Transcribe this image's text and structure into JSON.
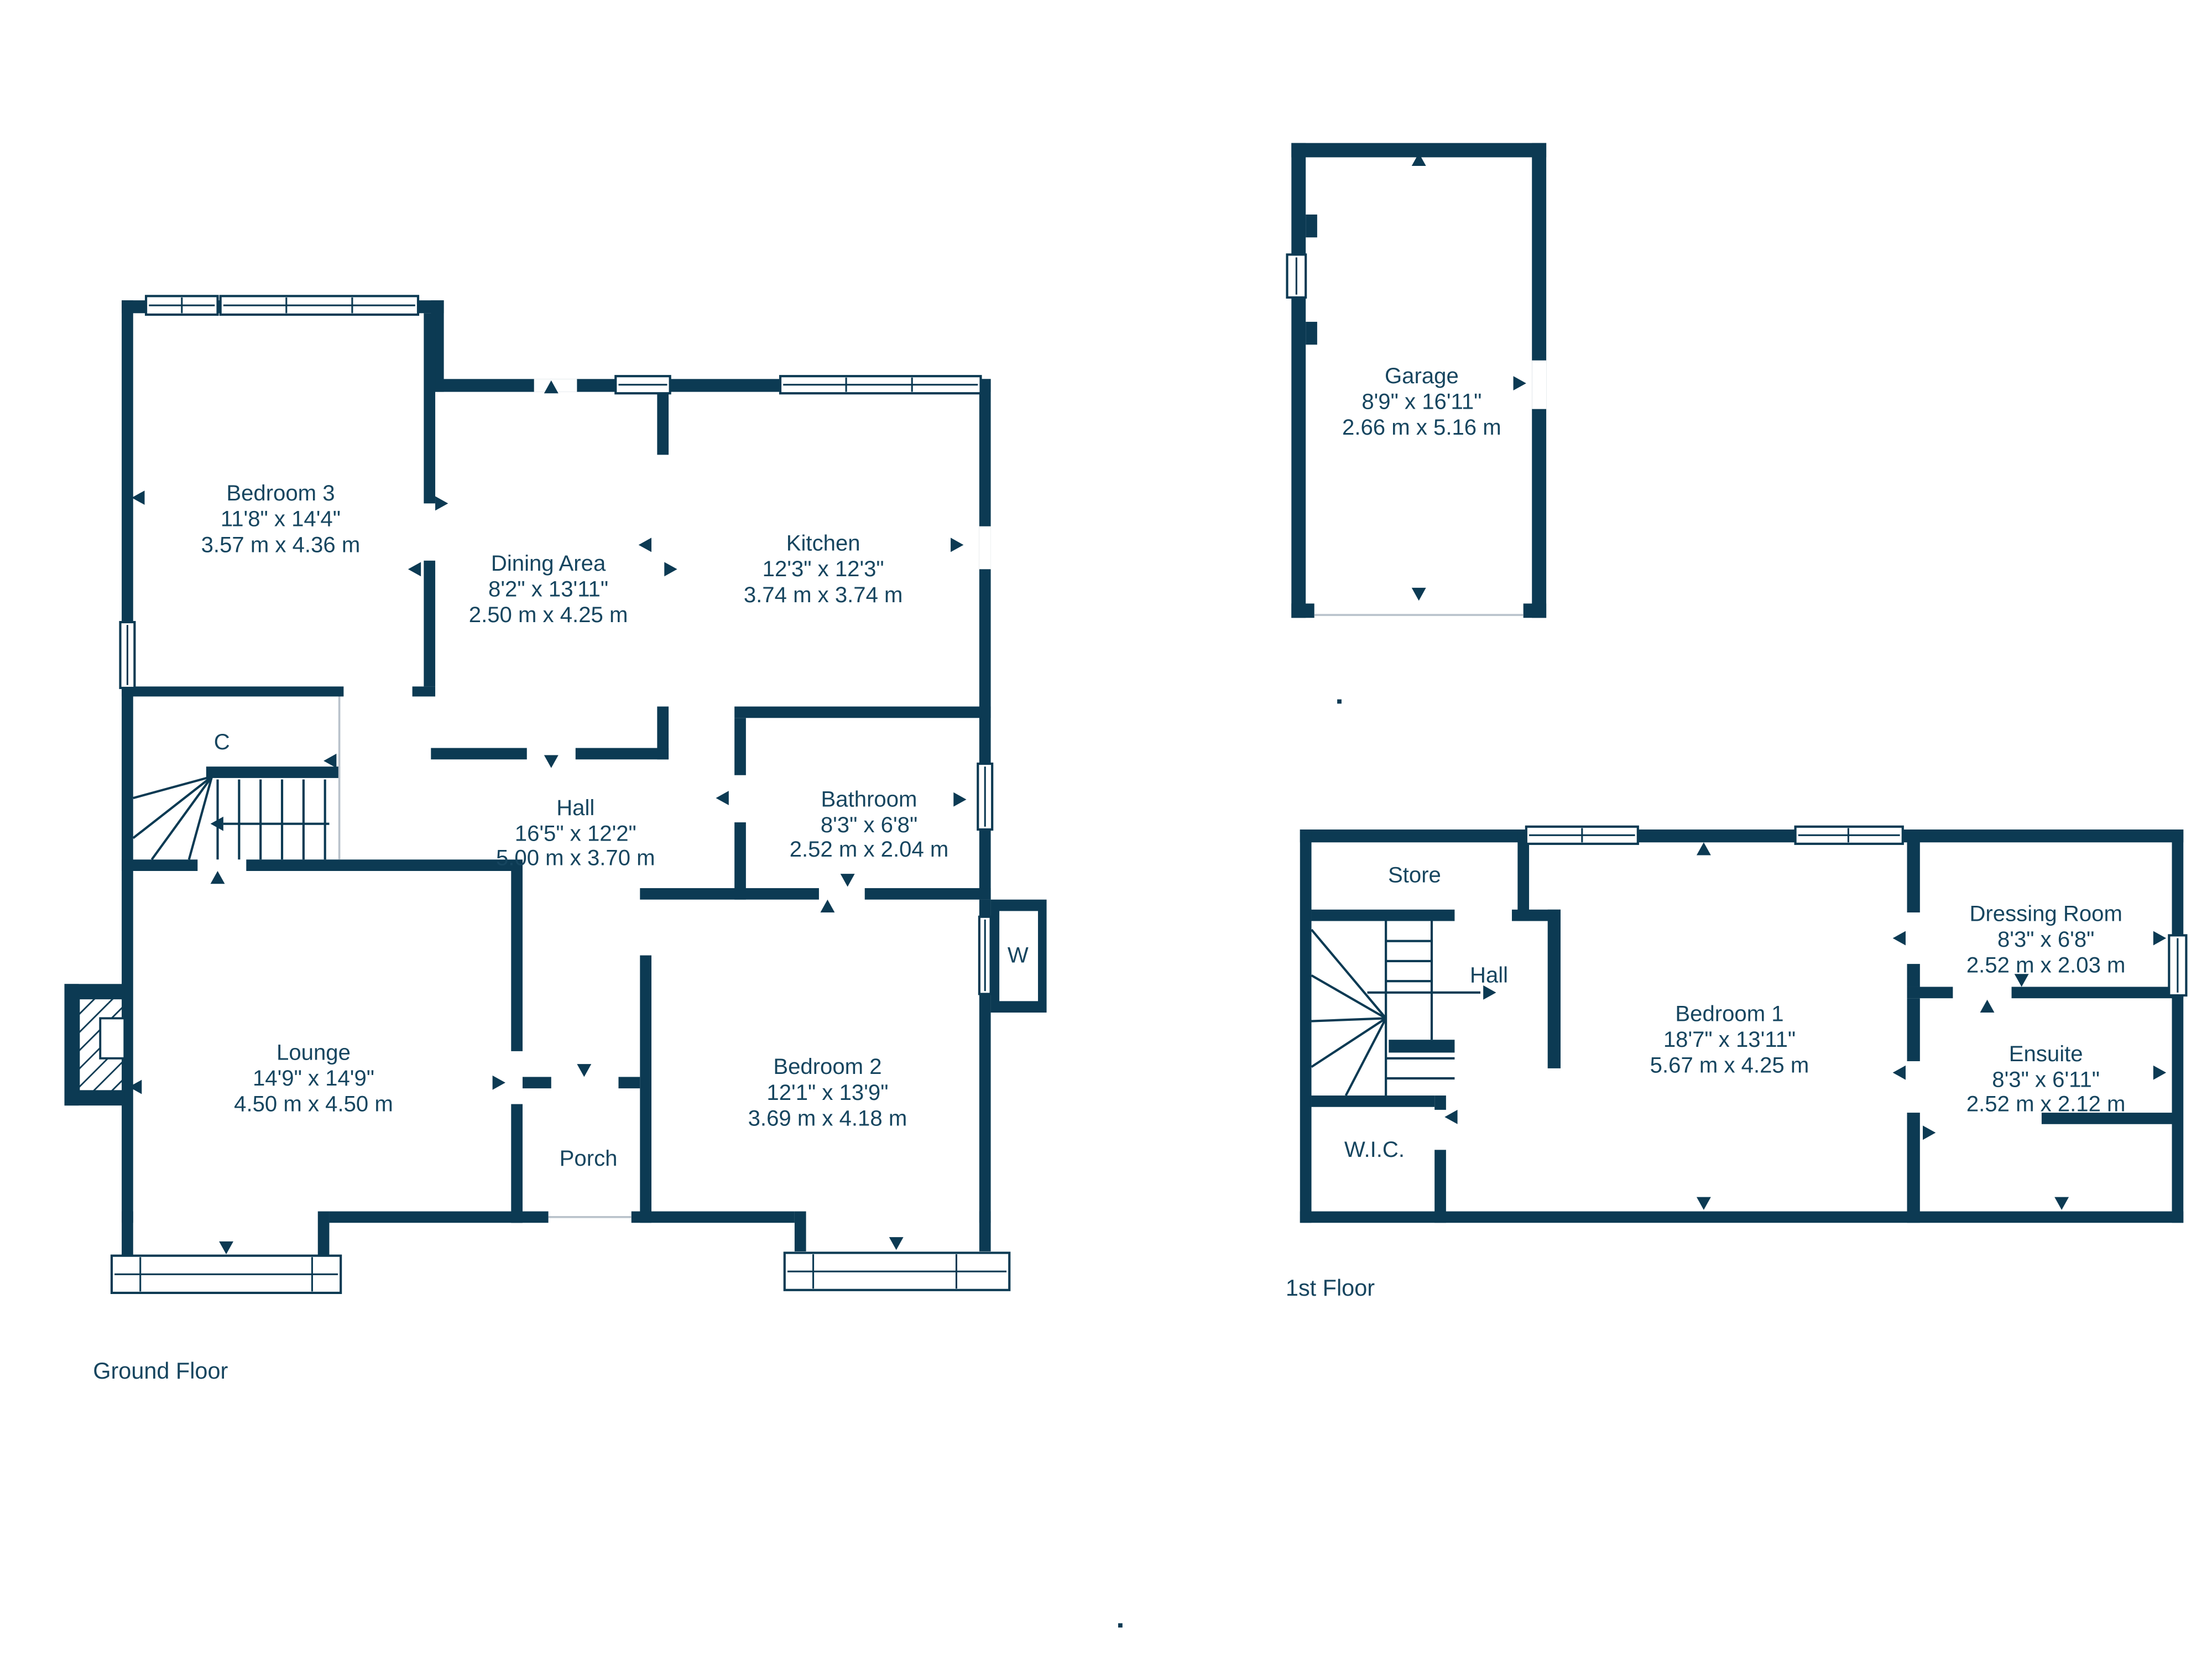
{
  "colors": {
    "wall": "#0c3a53",
    "text": "#16455f",
    "light_line": "#b9c2cb"
  },
  "floors": {
    "ground": {
      "label": "Ground Floor",
      "rooms": {
        "bedroom3": {
          "name": "Bedroom 3",
          "imperial": "11'8\" x 14'4\"",
          "metric": "3.57 m x 4.36 m"
        },
        "dining": {
          "name": "Dining Area",
          "imperial": "8'2\" x 13'11\"",
          "metric": "2.50 m x 4.25 m"
        },
        "kitchen": {
          "name": "Kitchen",
          "imperial": "12'3\" x 12'3\"",
          "metric": "3.74 m x 3.74 m"
        },
        "hall": {
          "name": "Hall",
          "imperial": "16'5\" x 12'2\"",
          "metric": "5.00 m x 3.70 m"
        },
        "bathroom": {
          "name": "Bathroom",
          "imperial": "8'3\" x 6'8\"",
          "metric": "2.52 m x 2.04 m"
        },
        "lounge": {
          "name": "Lounge",
          "imperial": "14'9\" x 14'9\"",
          "metric": "4.50 m x 4.50 m"
        },
        "bedroom2": {
          "name": "Bedroom 2",
          "imperial": "12'1\" x 13'9\"",
          "metric": "3.69 m x 4.18 m"
        },
        "porch": {
          "name": "Porch"
        },
        "cupboard": {
          "name": "C"
        },
        "wardrobe": {
          "name": "W"
        }
      }
    },
    "first": {
      "label": "1st Floor",
      "rooms": {
        "store": {
          "name": "Store"
        },
        "hall": {
          "name": "Hall"
        },
        "bedroom1": {
          "name": "Bedroom 1",
          "imperial": "18'7\" x 13'11\"",
          "metric": "5.67 m x 4.25 m"
        },
        "dressing": {
          "name": "Dressing Room",
          "imperial": "8'3\" x 6'8\"",
          "metric": "2.52 m x 2.03 m"
        },
        "ensuite": {
          "name": "Ensuite",
          "imperial": "8'3\" x 6'11\"",
          "metric": "2.52 m x 2.12 m"
        },
        "wic": {
          "name": "W.I.C."
        }
      }
    }
  },
  "garage": {
    "name": "Garage",
    "imperial": "8'9\" x 16'11\"",
    "metric": "2.66 m x 5.16 m"
  }
}
